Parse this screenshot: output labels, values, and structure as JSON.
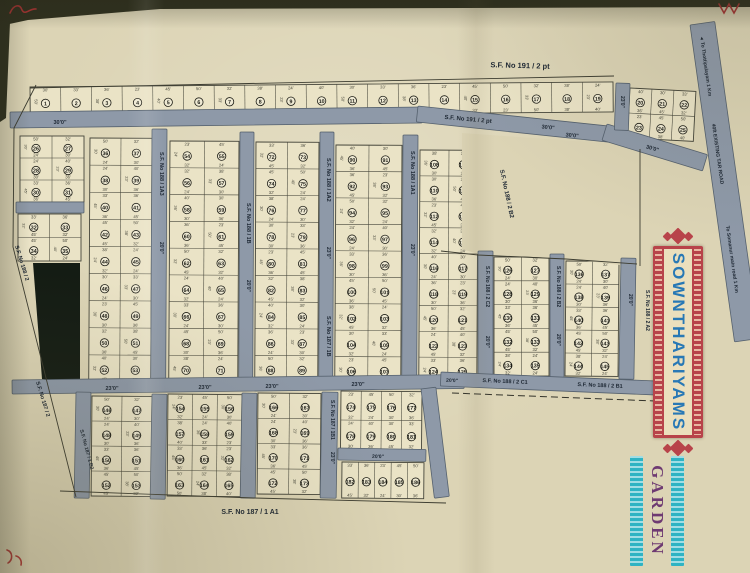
{
  "banner": {
    "title": "SOWNTHARIYAMS",
    "subtitle": "GARDEN",
    "title_color": "#2878b5",
    "frame_color": "#b8434a",
    "panel_color": "#ebdfbd",
    "subtitle_color": "#6e3a72",
    "subtitle_bar_color": "#2fb3c3"
  },
  "map": {
    "colors": {
      "paper": "#dcd4b5",
      "block_fill": "#eae3c6",
      "line": "#45453a",
      "road_fill": "#8e99a8",
      "road_edge": "#55616e",
      "label": "#1d2733",
      "plot_num": "#1b1b14",
      "dark_area": "#141c14",
      "edge": "#30311f",
      "ink": "#b23535"
    },
    "photo_edges": [
      {
        "pts": "0,0 750,0 750,7 160,9 28,20 0,26"
      },
      {
        "pts": "0,20 10,22 6,118 0,122"
      }
    ],
    "plot_dims": [
      "40'",
      "30'",
      "33'",
      "36'",
      "23'",
      "45'",
      "50'",
      "32'",
      "38'",
      "24'"
    ],
    "blocks": [
      {
        "x": 30,
        "y": 87,
        "w": 583,
        "h": 30,
        "rows": 1,
        "cols": 19,
        "rot": -0.5,
        "s": 1
      },
      {
        "x": 630,
        "y": 88,
        "w": 66,
        "h": 50,
        "rows": 2,
        "cols": 3,
        "rot": 3,
        "s": 20
      },
      {
        "x": 20,
        "y": 136,
        "w": 64,
        "h": 66,
        "rows": 3,
        "cols": 2,
        "rot": 0,
        "s": 26
      },
      {
        "x": 18,
        "y": 214,
        "w": 63,
        "h": 47,
        "rows": 2,
        "cols": 2,
        "rot": 0,
        "s": 32
      },
      {
        "x": 90,
        "y": 138,
        "w": 62,
        "h": 244,
        "rows": 9,
        "cols": 2,
        "rot": 0.3,
        "s": 36
      },
      {
        "x": 170,
        "y": 141,
        "w": 69,
        "h": 241,
        "rows": 9,
        "cols": 2,
        "rot": 0.3,
        "s": 54
      },
      {
        "x": 256,
        "y": 142,
        "w": 63,
        "h": 240,
        "rows": 9,
        "cols": 2,
        "rot": 0.3,
        "s": 72
      },
      {
        "x": 336,
        "y": 145,
        "w": 66,
        "h": 238,
        "rows": 9,
        "cols": 2,
        "rot": 0.3,
        "s": 90
      },
      {
        "x": 420,
        "y": 150,
        "w": 58,
        "h": 233,
        "rows": 9,
        "cols": 2,
        "rot": 0.3,
        "s": 108
      },
      {
        "x": 494,
        "y": 257,
        "w": 55,
        "h": 119,
        "rows": 5,
        "cols": 2,
        "rot": 0,
        "s": 126
      },
      {
        "x": 566,
        "y": 261,
        "w": 53,
        "h": 115,
        "rows": 5,
        "cols": 2,
        "rot": 0.5,
        "s": 136
      },
      {
        "x": 92,
        "y": 396,
        "w": 60,
        "h": 100,
        "rows": 4,
        "cols": 2,
        "rot": 0.5,
        "s": 146
      },
      {
        "x": 168,
        "y": 394,
        "w": 74,
        "h": 102,
        "rows": 4,
        "cols": 3,
        "rot": 0.5,
        "s": 154
      },
      {
        "x": 258,
        "y": 393,
        "w": 63,
        "h": 101,
        "rows": 4,
        "cols": 2,
        "rot": 0.5,
        "s": 166
      },
      {
        "x": 341,
        "y": 391,
        "w": 81,
        "h": 58,
        "rows": 2,
        "cols": 4,
        "rot": 0.5,
        "s": 174
      },
      {
        "x": 342,
        "y": 462,
        "w": 82,
        "h": 36,
        "rows": 1,
        "cols": 5,
        "rot": 0.5,
        "s": 182
      }
    ],
    "blank_area": {
      "pts": "462,133 645,146 645,268 570,259 478,254 462,249"
    },
    "dark_area": {
      "pts": "33,263 80,263 80,384 42,379"
    },
    "roads": [
      {
        "x": 10,
        "y": 112,
        "w": 412,
        "h": 16,
        "rot": -0.7
      },
      {
        "x": 418,
        "y": 106,
        "w": 200,
        "h": 16,
        "rot": 6
      },
      {
        "x": 607,
        "y": 124,
        "w": 105,
        "h": 17,
        "rot": 17
      },
      {
        "x": 616,
        "y": 83,
        "w": 14,
        "h": 47,
        "rot": 2
      },
      {
        "x": 152,
        "y": 129,
        "w": 15,
        "h": 256,
        "rot": 0.3
      },
      {
        "x": 240,
        "y": 132,
        "w": 14,
        "h": 253,
        "rot": 0.3
      },
      {
        "x": 320,
        "y": 132,
        "w": 14,
        "h": 253,
        "rot": 0.3
      },
      {
        "x": 403,
        "y": 135,
        "w": 15,
        "h": 250,
        "rot": 0.3
      },
      {
        "x": 478,
        "y": 251,
        "w": 15,
        "h": 127,
        "rot": 0
      },
      {
        "x": 550,
        "y": 254,
        "w": 14,
        "h": 124,
        "rot": 0
      },
      {
        "x": 621,
        "y": 258,
        "w": 15,
        "h": 121,
        "rot": 1
      },
      {
        "x": 12,
        "y": 380,
        "w": 452,
        "h": 14,
        "rot": -0.7
      },
      {
        "x": 441,
        "y": 372,
        "w": 218,
        "h": 14,
        "rot": 2.4
      },
      {
        "x": 16,
        "y": 202,
        "w": 68,
        "h": 11,
        "rot": 0
      },
      {
        "x": 76,
        "y": 392,
        "w": 15,
        "h": 106,
        "rot": 1
      },
      {
        "x": 152,
        "y": 394,
        "w": 15,
        "h": 105,
        "rot": 1
      },
      {
        "x": 242,
        "y": 393,
        "w": 15,
        "h": 105,
        "rot": 1
      },
      {
        "x": 322,
        "y": 392,
        "w": 16,
        "h": 106,
        "rot": 1
      },
      {
        "x": 421,
        "y": 389,
        "w": 15,
        "h": 110,
        "rot": -7
      },
      {
        "x": 338,
        "y": 448,
        "w": 88,
        "h": 12,
        "rot": 1
      },
      {
        "x": 690,
        "y": 25,
        "w": 25,
        "h": 320,
        "rot": -8,
        "name": "tar-road"
      }
    ],
    "boundaries": [
      {
        "pts": "36,85 14,128 13,247 76,497"
      },
      {
        "pts": "60,491 254,498 446,503"
      },
      {
        "pts": "30,88 614,76"
      },
      {
        "pts": "640,149 640,266"
      },
      {
        "pts": "441,251 478,255 566,259 637,264"
      }
    ],
    "dashed_lines": [
      {
        "pts": "452,393 655,401"
      }
    ],
    "labels": [
      {
        "t": "S.F. No  191 / 2 pt",
        "x": 520,
        "y": 68,
        "r": 1.5,
        "s": 7.5,
        "a": "m"
      },
      {
        "t": "S.F. No  191 / 2 pt",
        "x": 468,
        "y": 121,
        "r": 5,
        "s": 6,
        "a": "m"
      },
      {
        "t": "30'0\"",
        "x": 548,
        "y": 129,
        "r": 5,
        "s": 5.5,
        "a": "m"
      },
      {
        "t": "30'0\"",
        "x": 60,
        "y": 124,
        "r": 0,
        "s": 5.5,
        "a": "m"
      },
      {
        "t": "30'0\"",
        "x": 572,
        "y": 137,
        "r": 6,
        "s": 5.5,
        "a": "m"
      },
      {
        "t": "30'0\"",
        "x": 652,
        "y": 150,
        "r": 16,
        "s": 5.5,
        "a": "m"
      },
      {
        "t": "23'0\"",
        "x": 621,
        "y": 96,
        "r": 90,
        "s": 5,
        "a": "s"
      },
      {
        "t": "S.F. No 188 / 1A3",
        "x": 160,
        "y": 152,
        "r": 90,
        "s": 5.5,
        "a": "s"
      },
      {
        "t": "20'0\"",
        "x": 160,
        "y": 242,
        "r": 90,
        "s": 5,
        "a": "s"
      },
      {
        "t": "S.F. No 188 / 1B",
        "x": 247,
        "y": 203,
        "r": 90,
        "s": 5.5,
        "a": "s"
      },
      {
        "t": "20'0\"",
        "x": 247,
        "y": 280,
        "r": 90,
        "s": 5,
        "a": "s"
      },
      {
        "t": "S.F. No 188 / 1A2",
        "x": 327,
        "y": 158,
        "r": 90,
        "s": 5.5,
        "a": "s"
      },
      {
        "t": "23'0\"",
        "x": 327,
        "y": 247,
        "r": 90,
        "s": 5,
        "a": "s"
      },
      {
        "t": "S.F. No 187 / 1B",
        "x": 327,
        "y": 316,
        "r": 90,
        "s": 5.5,
        "a": "s"
      },
      {
        "t": "S.F. No 188 / 1A1",
        "x": 411,
        "y": 151,
        "r": 90,
        "s": 5.5,
        "a": "s"
      },
      {
        "t": "23'0\"",
        "x": 411,
        "y": 244,
        "r": 90,
        "s": 5,
        "a": "s"
      },
      {
        "t": "S.F. No 188 / 2 C2",
        "x": 486,
        "y": 266,
        "r": 90,
        "s": 5,
        "a": "s"
      },
      {
        "t": "20'0\"",
        "x": 486,
        "y": 336,
        "r": 90,
        "s": 5,
        "a": "s"
      },
      {
        "t": "S.F. No 188 / 2 B2",
        "x": 557,
        "y": 266,
        "r": 90,
        "s": 5,
        "a": "s"
      },
      {
        "t": "20'0\"",
        "x": 557,
        "y": 334,
        "r": 90,
        "s": 5,
        "a": "s"
      },
      {
        "t": "20'0\"",
        "x": 629,
        "y": 294,
        "r": 90,
        "s": 5,
        "a": "s"
      },
      {
        "t": "S.F. No 188 / 2 A2",
        "x": 646,
        "y": 290,
        "r": 90,
        "s": 5,
        "a": "s"
      },
      {
        "t": "23'0\"",
        "x": 112,
        "y": 390,
        "r": 0,
        "s": 5.5,
        "a": "m"
      },
      {
        "t": "23'0\"",
        "x": 205,
        "y": 389,
        "r": 0,
        "s": 5.5,
        "a": "m"
      },
      {
        "t": "23'0\"",
        "x": 272,
        "y": 388,
        "r": 0,
        "s": 5.5,
        "a": "m"
      },
      {
        "t": "23'0\"",
        "x": 358,
        "y": 386,
        "r": 0,
        "s": 5.5,
        "a": "m"
      },
      {
        "t": "20'0\"",
        "x": 452,
        "y": 382,
        "r": 2.4,
        "s": 5,
        "a": "m"
      },
      {
        "t": "S.F. No  188 / 2 C1",
        "x": 505,
        "y": 383,
        "r": 2.4,
        "s": 5.5,
        "a": "m"
      },
      {
        "t": "S.F. No  188 / 2 B1",
        "x": 600,
        "y": 387,
        "r": 2.4,
        "s": 5.5,
        "a": "m"
      },
      {
        "t": "20'0\"",
        "x": 378,
        "y": 458,
        "r": 1,
        "s": 5,
        "a": "m"
      },
      {
        "t": "S.F. No 187 / 1B1",
        "x": 331,
        "y": 400,
        "r": 90,
        "s": 5,
        "a": "s"
      },
      {
        "t": "23'0\"",
        "x": 331,
        "y": 452,
        "r": 90,
        "s": 5,
        "a": "s"
      },
      {
        "t": "S.F. No 187 / 1 B2",
        "x": 80,
        "y": 430,
        "r": 75,
        "s": 5,
        "a": "s"
      },
      {
        "t": "S.F. No 188 / 2",
        "x": 15,
        "y": 246,
        "r": 73,
        "s": 5.5,
        "a": "s"
      },
      {
        "t": "S.F. No 187 / 2",
        "x": 36,
        "y": 382,
        "r": 73,
        "s": 5.5,
        "a": "s"
      },
      {
        "t": "S.F. No 188 / 2 B2",
        "x": 500,
        "y": 170,
        "r": 78,
        "s": 6,
        "a": "s"
      },
      {
        "t": "S.F. No  187 / 1 A1",
        "x": 250,
        "y": 514,
        "r": 0,
        "s": 7,
        "a": "m"
      },
      {
        "t": "◄  To Thottipalayam   1 Km",
        "x": 700,
        "y": 36,
        "r": 82,
        "s": 5,
        "a": "s"
      },
      {
        "t": "40ft EXISTING TAR ROAD",
        "x": 712,
        "y": 124,
        "r": 82,
        "s": 5,
        "a": "s"
      },
      {
        "t": "To Somanur main road   1 Km",
        "x": 726,
        "y": 226,
        "r": 82,
        "s": 5,
        "a": "s"
      }
    ],
    "ink_marks": [
      {
        "d": "M10,13 C14,4 20,4 22,10 C25,16 30,8 36,9"
      },
      {
        "d": "M719,4 l5,9 5,-9 5,9 5,-9"
      },
      {
        "d": "M7,550 c6,2 6,10 1,13 M16,556 c4,1 6,5 5,9"
      }
    ]
  }
}
